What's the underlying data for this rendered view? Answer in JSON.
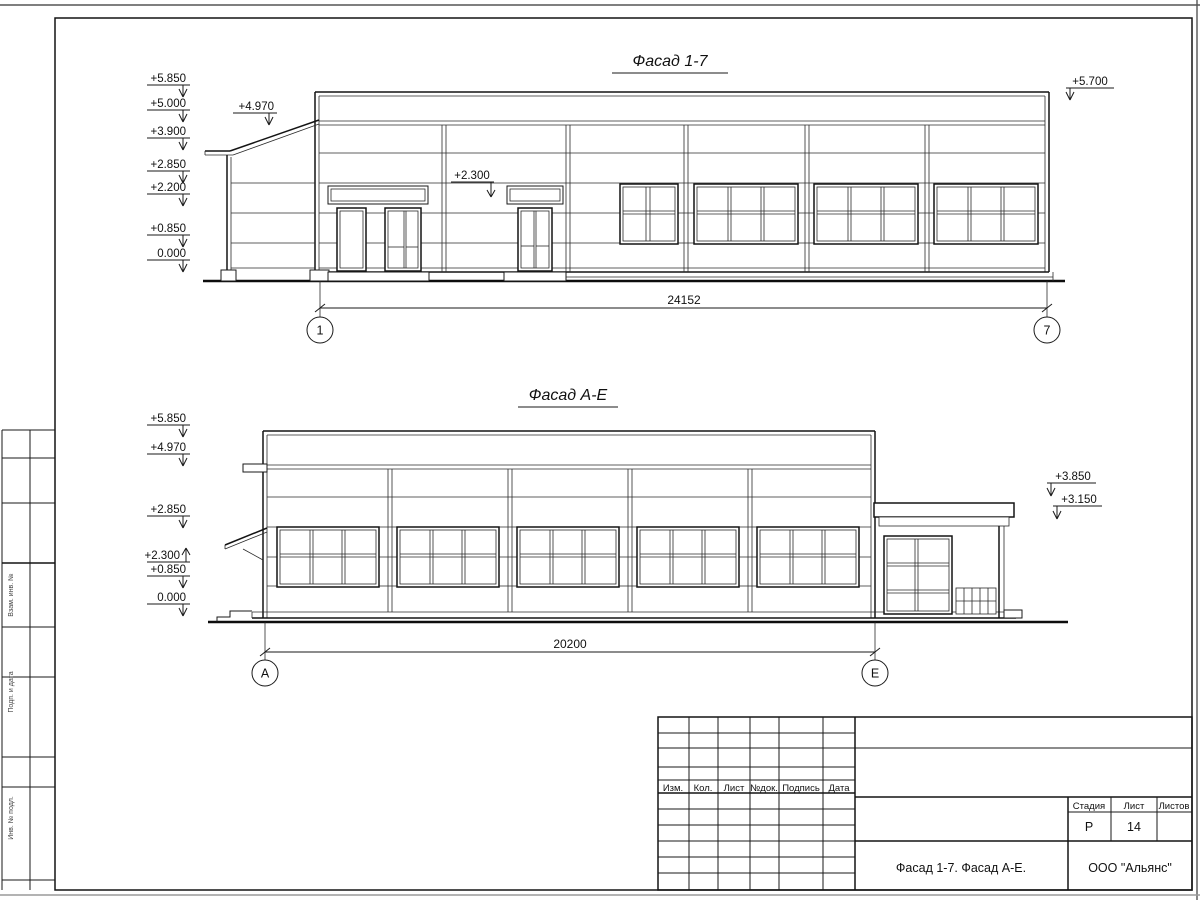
{
  "facade_1_7": {
    "title": "Фасад 1-7",
    "levels": [
      "+5.850",
      "+5.000",
      "+3.900",
      "+2.850",
      "+2.200",
      "+0.850",
      "0.000"
    ],
    "canopy_level": "+4.970",
    "entry_level": "+2.300",
    "right_level": "+5.700",
    "dimension": "24152",
    "axis_start": "1",
    "axis_end": "7"
  },
  "facade_a_e": {
    "title": "Фасад А-Е",
    "levels": [
      "+5.850",
      "+4.970",
      "+2.850",
      "+2.300",
      "+0.850",
      "0.000"
    ],
    "annex_roof_level": "+3.850",
    "annex_eave_level": "+3.150",
    "dimension": "20200",
    "axis_start": "А",
    "axis_end": "Е"
  },
  "title_block": {
    "columns": [
      "Изм.",
      "Кол.",
      "Лист",
      "№док.",
      "Подпись",
      "Дата"
    ],
    "stage_label": "Стадия",
    "sheet_label": "Лист",
    "sheets_label": "Листов",
    "stage": "Р",
    "sheet": "14",
    "sheets": "",
    "doc_title": "Фасад 1-7. Фасад А-Е.",
    "company": "ООО \"Альянс\""
  },
  "side_stamp": {
    "labels": [
      "Взам. инв. №",
      "Подп. и дата",
      "Инв. № подл."
    ]
  }
}
